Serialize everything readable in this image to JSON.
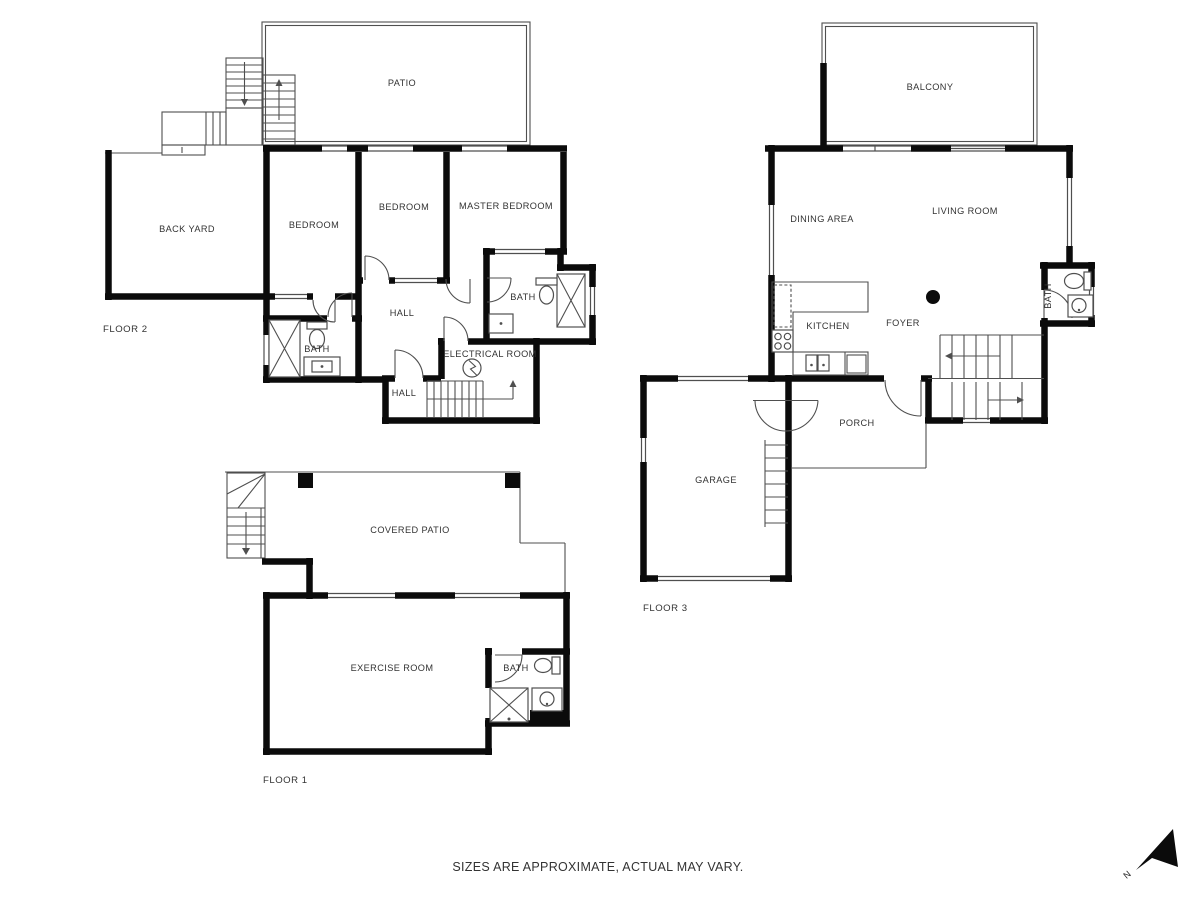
{
  "colors": {
    "wall": "#0b0b0b",
    "thin_line": "#4f4f4f",
    "label_text": "#333333",
    "background": "#ffffff"
  },
  "floor2": {
    "label": "FLOOR 2",
    "rooms": {
      "patio": "PATIO",
      "back_yard": "BACK YARD",
      "bedroom_left": "BEDROOM",
      "bedroom_mid": "BEDROOM",
      "master_bedroom": "MASTER BEDROOM",
      "hall_upper": "HALL",
      "hall_lower": "HALL",
      "bath_left": "BATH",
      "bath_right": "BATH",
      "electrical": "ELECTRICAL ROOM"
    }
  },
  "floor3": {
    "label": "FLOOR 3",
    "rooms": {
      "balcony": "BALCONY",
      "dining": "DINING AREA",
      "living": "LIVING ROOM",
      "kitchen": "KITCHEN",
      "foyer": "FOYER",
      "bath": "BATH",
      "porch": "PORCH",
      "garage": "GARAGE"
    }
  },
  "floor1": {
    "label": "FLOOR 1",
    "rooms": {
      "covered_patio": "COVERED PATIO",
      "exercise": "EXERCISE ROOM",
      "bath": "BATH"
    }
  },
  "footer": {
    "disclaimer": "SIZES ARE APPROXIMATE, ACTUAL MAY VARY."
  },
  "compass": {
    "north": "N"
  }
}
